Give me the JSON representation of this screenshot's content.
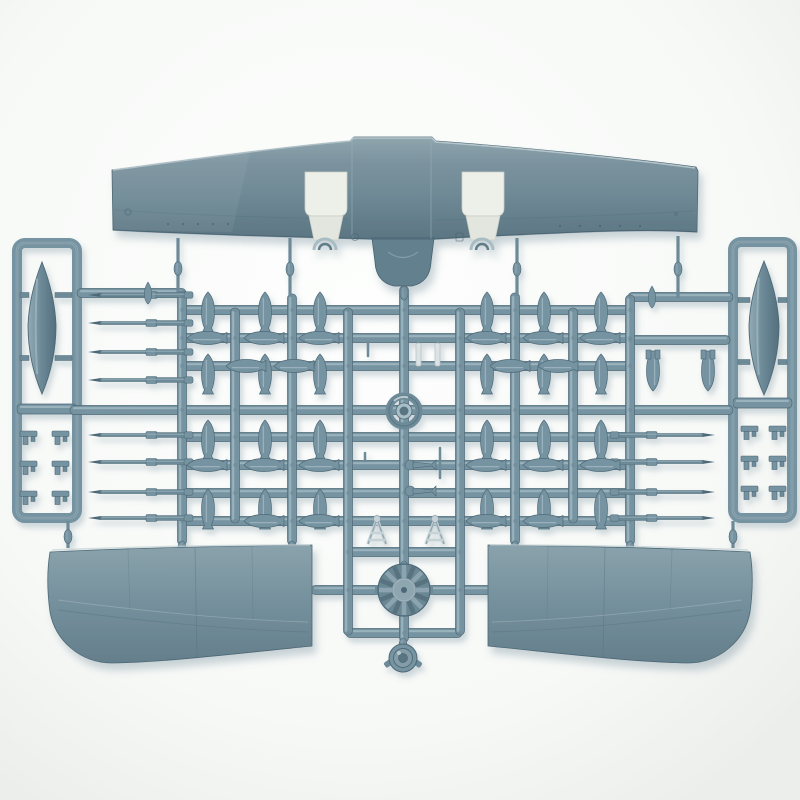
{
  "scene": {
    "subject": "photograph of an injection-molded plastic model kit sprue for a single-engine propeller aircraft",
    "background": "white seamless backdrop",
    "plastic_finish": "gray-blue styrene with specular highlights"
  },
  "colors": {
    "background": "#fafbf9",
    "vignette_edge": "#eceeec",
    "plastic_base": "#6d8a98",
    "plastic_mid": "#7693a1",
    "plastic_dark": "#4e6977",
    "plastic_light": "#a9bfc8",
    "plastic_specular": "#cfdbdf",
    "opening_white": "#edefe9",
    "opening_shade": "#dfe3dc",
    "shadow": "#6e8796"
  },
  "geometry": {
    "runners_h": [
      [
        77,
        186,
        293
      ],
      [
        628,
        733,
        297
      ],
      [
        182,
        630,
        310
      ],
      [
        182,
        630,
        338
      ],
      [
        630,
        730,
        340
      ],
      [
        182,
        630,
        366
      ],
      [
        70,
        733,
        410
      ],
      [
        182,
        630,
        437
      ],
      [
        182,
        630,
        465
      ],
      [
        182,
        630,
        493
      ],
      [
        182,
        630,
        521
      ],
      [
        346,
        462,
        552
      ],
      [
        311,
        381,
        590
      ],
      [
        429,
        491,
        590
      ],
      [
        346,
        462,
        633
      ]
    ],
    "runners_v": [
      [
        182,
        291,
        545
      ],
      [
        235,
        308,
        523
      ],
      [
        292,
        294,
        545
      ],
      [
        348,
        308,
        635
      ],
      [
        404,
        286,
        642
      ],
      [
        460,
        308,
        635
      ],
      [
        515,
        293,
        545
      ],
      [
        573,
        308,
        523
      ],
      [
        630,
        295,
        545
      ]
    ],
    "gates": [
      [
        178,
        238,
        295
      ],
      [
        290,
        238,
        296
      ],
      [
        517,
        238,
        296
      ],
      [
        678,
        236,
        298
      ],
      [
        404,
        284,
        298
      ],
      [
        182,
        543,
        549
      ],
      [
        292,
        543,
        549
      ],
      [
        515,
        543,
        549
      ],
      [
        630,
        543,
        549
      ],
      [
        68,
        521,
        548
      ],
      [
        733,
        521,
        548
      ],
      [
        404,
        563,
        569
      ],
      [
        403,
        640,
        646
      ]
    ],
    "rockets": {
      "left_rows": [
        295,
        323,
        352,
        380,
        435,
        462,
        492,
        518
      ],
      "right_rows": [
        435,
        462,
        492,
        518
      ],
      "mirror_axis": 803
    },
    "bombs_vertical": [
      [
        208,
        313
      ],
      [
        265,
        313
      ],
      [
        320,
        313
      ],
      [
        487,
        313
      ],
      [
        544,
        313
      ],
      [
        601,
        313
      ],
      [
        208,
        375
      ],
      [
        265,
        375
      ],
      [
        320,
        375
      ],
      [
        487,
        375
      ],
      [
        544,
        375
      ],
      [
        601,
        375
      ],
      [
        208,
        441
      ],
      [
        265,
        441
      ],
      [
        320,
        441
      ],
      [
        487,
        441
      ],
      [
        544,
        441
      ],
      [
        601,
        441
      ],
      [
        208,
        510
      ],
      [
        265,
        510
      ],
      [
        320,
        510
      ],
      [
        487,
        510
      ],
      [
        544,
        510
      ],
      [
        601,
        510
      ]
    ],
    "bombs_horizontal": [
      [
        208,
        338
      ],
      [
        265,
        338
      ],
      [
        320,
        338
      ],
      [
        487,
        338
      ],
      [
        544,
        338
      ],
      [
        601,
        338
      ],
      [
        247,
        366
      ],
      [
        295,
        366
      ],
      [
        511,
        366
      ],
      [
        559,
        366
      ],
      [
        208,
        465
      ],
      [
        265,
        465
      ],
      [
        320,
        465
      ],
      [
        487,
        465
      ],
      [
        544,
        465
      ],
      [
        601,
        465
      ],
      [
        265,
        521
      ],
      [
        320,
        521
      ],
      [
        487,
        521
      ],
      [
        544,
        521
      ]
    ],
    "bombs_nose_down": [
      [
        653,
        370
      ],
      [
        708,
        370
      ]
    ],
    "teardrops": [
      [
        148,
        293
      ],
      [
        652,
        297
      ]
    ],
    "clips": [
      [
        20,
        431
      ],
      [
        52,
        431
      ],
      [
        20,
        461
      ],
      [
        52,
        461
      ],
      [
        20,
        491
      ],
      [
        52,
        491
      ],
      [
        741,
        426
      ],
      [
        769,
        426
      ],
      [
        741,
        456
      ],
      [
        769,
        456
      ],
      [
        741,
        486
      ],
      [
        769,
        486
      ]
    ],
    "fish_parts": [
      [
        410,
        465
      ],
      [
        410,
        491
      ]
    ],
    "gear_frames": [
      [
        377,
        517
      ],
      [
        435,
        517
      ]
    ],
    "light_strips": [
      [
        416,
        343,
        5,
        23
      ],
      [
        435,
        343,
        5,
        23
      ]
    ],
    "tiny_bits": [
      [
        368,
        342,
        368,
        356
      ],
      [
        440,
        448,
        440,
        478
      ],
      [
        365,
        453,
        365,
        461
      ]
    ],
    "drop_tanks": [
      {
        "cx": 42,
        "cy": 328,
        "rx": 14,
        "ry": 66,
        "frame": [
          17,
          243,
          60,
          275
        ],
        "crossbar": [
          17,
          404,
          60,
          10
        ],
        "stub_ys": [
          295,
          358
        ],
        "stubs": [
          [
            20,
            29
          ],
          [
            55,
            72
          ]
        ]
      },
      {
        "cx": 764,
        "cy": 328,
        "rx": 15,
        "ry": 67,
        "frame": [
          733,
          242,
          59,
          276
        ],
        "crossbar": [
          733,
          398,
          59,
          10
        ],
        "stub_ys": [
          300,
          362
        ],
        "stubs": [
          [
            738,
            750
          ],
          [
            778,
            787
          ]
        ]
      }
    ],
    "ring_part": {
      "cx": 404,
      "cy": 411,
      "r": 15
    },
    "engine": {
      "cx": 404,
      "cy": 590,
      "r": 26,
      "fins": 16,
      "hub_r": 11
    },
    "round_part": {
      "cx": 403,
      "cy": 658,
      "r": 14
    }
  }
}
